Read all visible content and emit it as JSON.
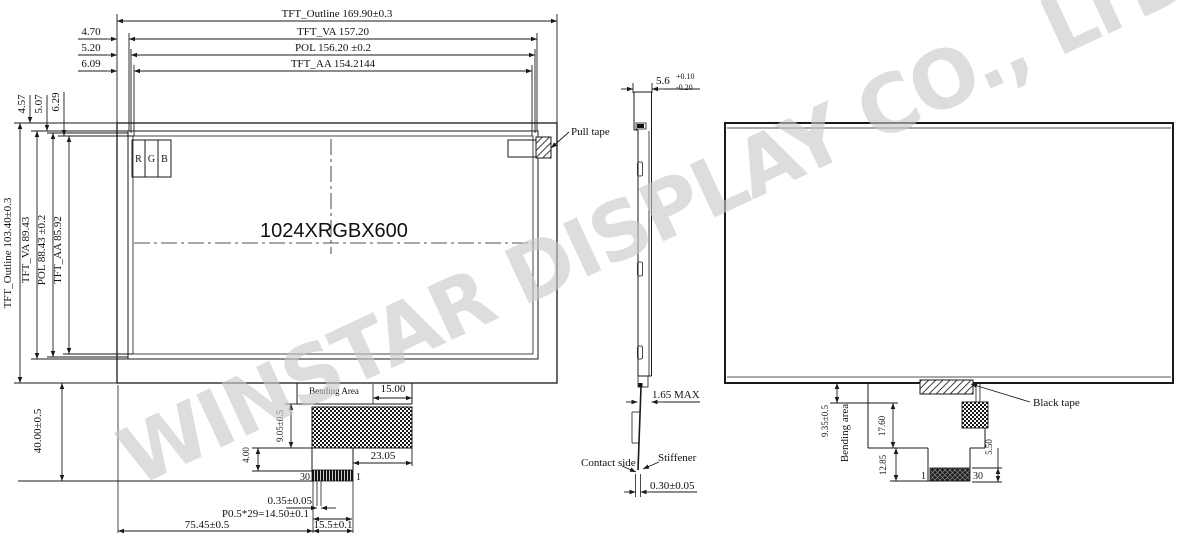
{
  "watermark_text": "WINSTAR DISPLAY CO., LTD.",
  "front_view": {
    "top_dims": {
      "outline": "TFT_Outline 169.90±0.3",
      "va": "TFT_VA 157.20",
      "pol": "POL 156.20 ±0.2",
      "aa": "TFT_AA 154.2144",
      "offset_va": "4.70",
      "offset_pol": "5.20",
      "offset_aa": "6.09",
      "offset_va_v": "4.57",
      "offset_pol_v": "5.07",
      "offset_aa_v": "6.29"
    },
    "left_dims": {
      "outline": "TFT_Outline 103.40±0.3",
      "va": "TFT_VA 89.43",
      "pol": "POL 88.43 ±0.2",
      "aa": "TFT_AA 85.92",
      "bottom": "40.00±0.5"
    },
    "pixel_r": "R",
    "pixel_g": "G",
    "pixel_b": "B",
    "resolution": "1024XRGBX600",
    "pull_tape_label": "Pull tape",
    "tail": {
      "bending_area": "Bending Area",
      "width_top": "15.00",
      "height_bend": "9.05±0.5",
      "height_stem": "4.00",
      "width_right": "23.05",
      "pin_left": "30",
      "pin_right": "1",
      "pin_width": "0.35±0.05",
      "pin_pitch": "P0.5*29=14.50±0.1",
      "offset_left": "75.45±0.5",
      "conn_width": "15.5±0.1"
    }
  },
  "side_view": {
    "thickness": "5.6",
    "tol_plus": "+0.10",
    "tol_minus": "-0.20",
    "max_label": "1.65 MAX",
    "contact_side_label": "Contact side",
    "stiffener_label": "Stiffener",
    "fpc_thickness": "0.30±0.05"
  },
  "back_view": {
    "black_tape_label": "Black tape",
    "height_bend": "9.35±0.5",
    "bending_area": "Bending area",
    "height_mid": "17.60",
    "height_low": "12.85",
    "conn_height": "5.50",
    "pin_left": "1",
    "pin_right": "30"
  }
}
